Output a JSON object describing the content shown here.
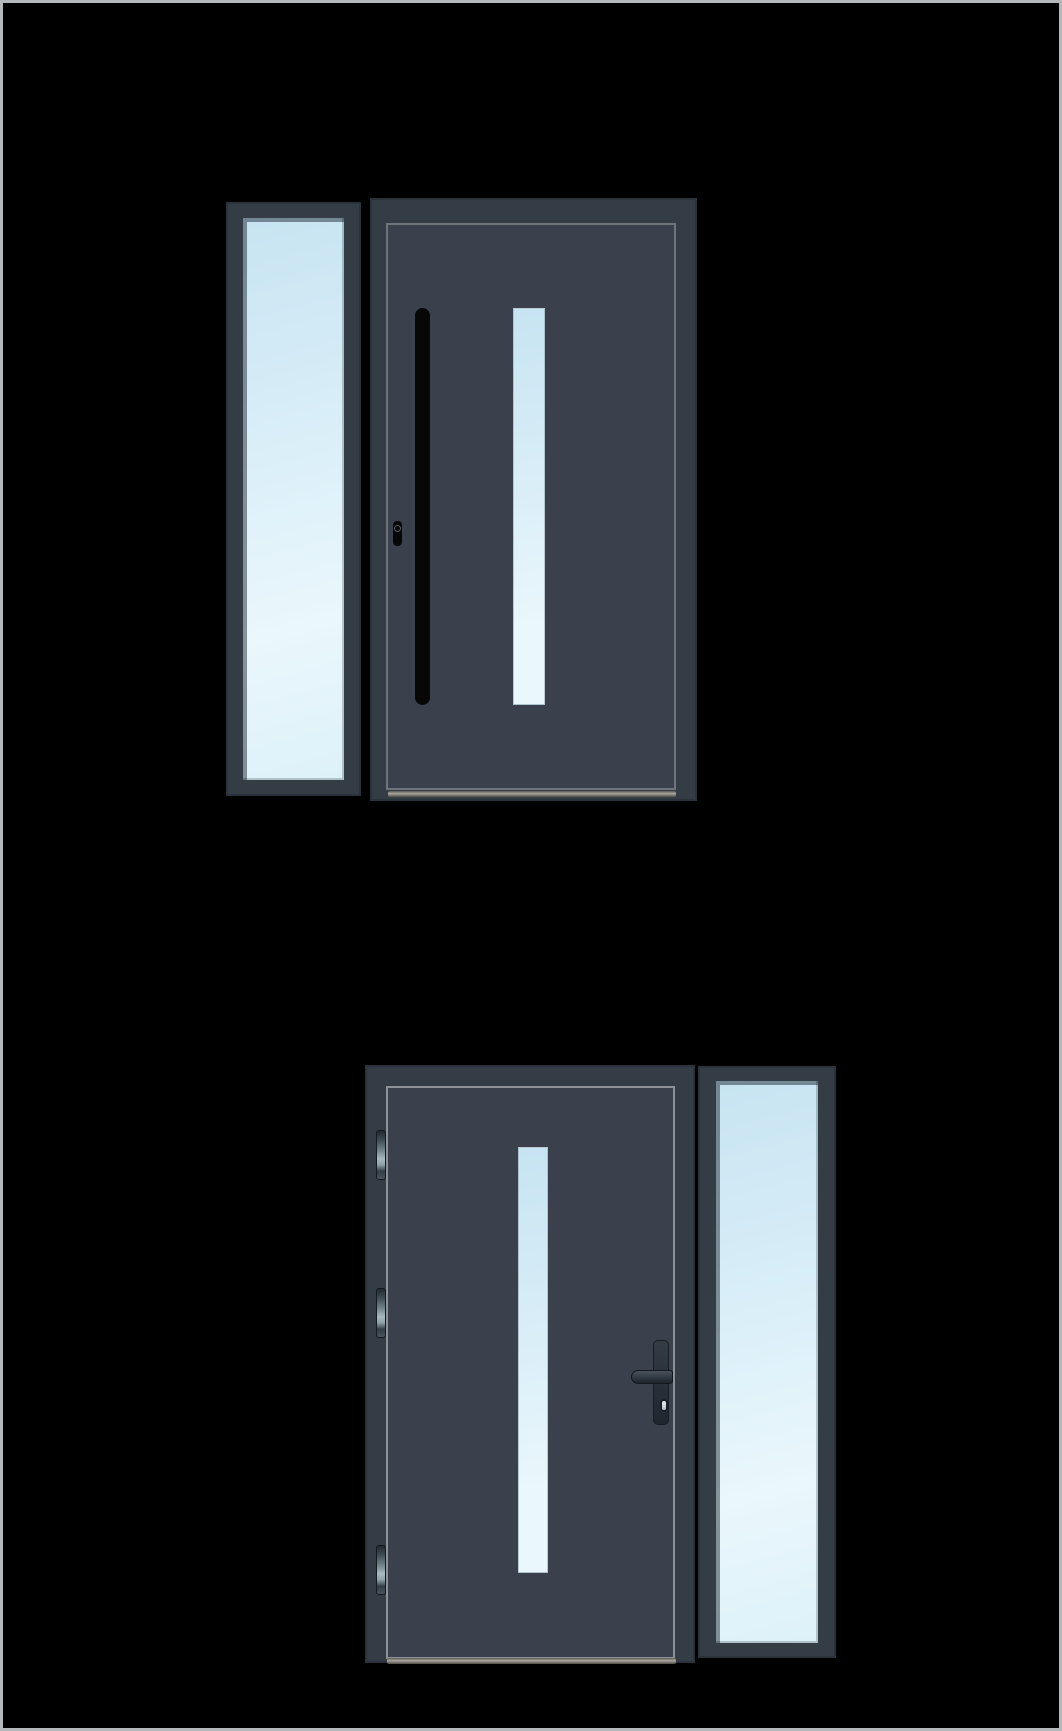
{
  "canvas": {
    "width": 1062,
    "height": 1731,
    "background": "#000000",
    "border_gray": "#b5b8ba"
  },
  "colors": {
    "frame": "#343c46",
    "frame_edge": "#2a323b",
    "leaf_inner": "#3a414c",
    "trim_line_top": "#70757c",
    "trim_line_bottom": "#8d9298",
    "glass_base": "#c7e4f2",
    "glass_light": "#eaf7fc",
    "handle_black": "#070707",
    "hinge_light": "#a8bac0",
    "sill_light": "#aaa79f",
    "sill_dark": "#4e4b46"
  },
  "door_options": [
    {
      "id": "door-option-1",
      "sidelight_position": "left",
      "handle": "vertical-pull-bar",
      "keyhole": "cylinder-left-of-bar",
      "glazing": "narrow-vertical-pane",
      "hinges_visible": 0
    },
    {
      "id": "door-option-2",
      "sidelight_position": "right",
      "handle": "lever-handle-with-backplate",
      "keyhole": "euro-cylinder-below-lever",
      "glazing": "narrow-vertical-pane",
      "hinges_visible": 3
    }
  ]
}
